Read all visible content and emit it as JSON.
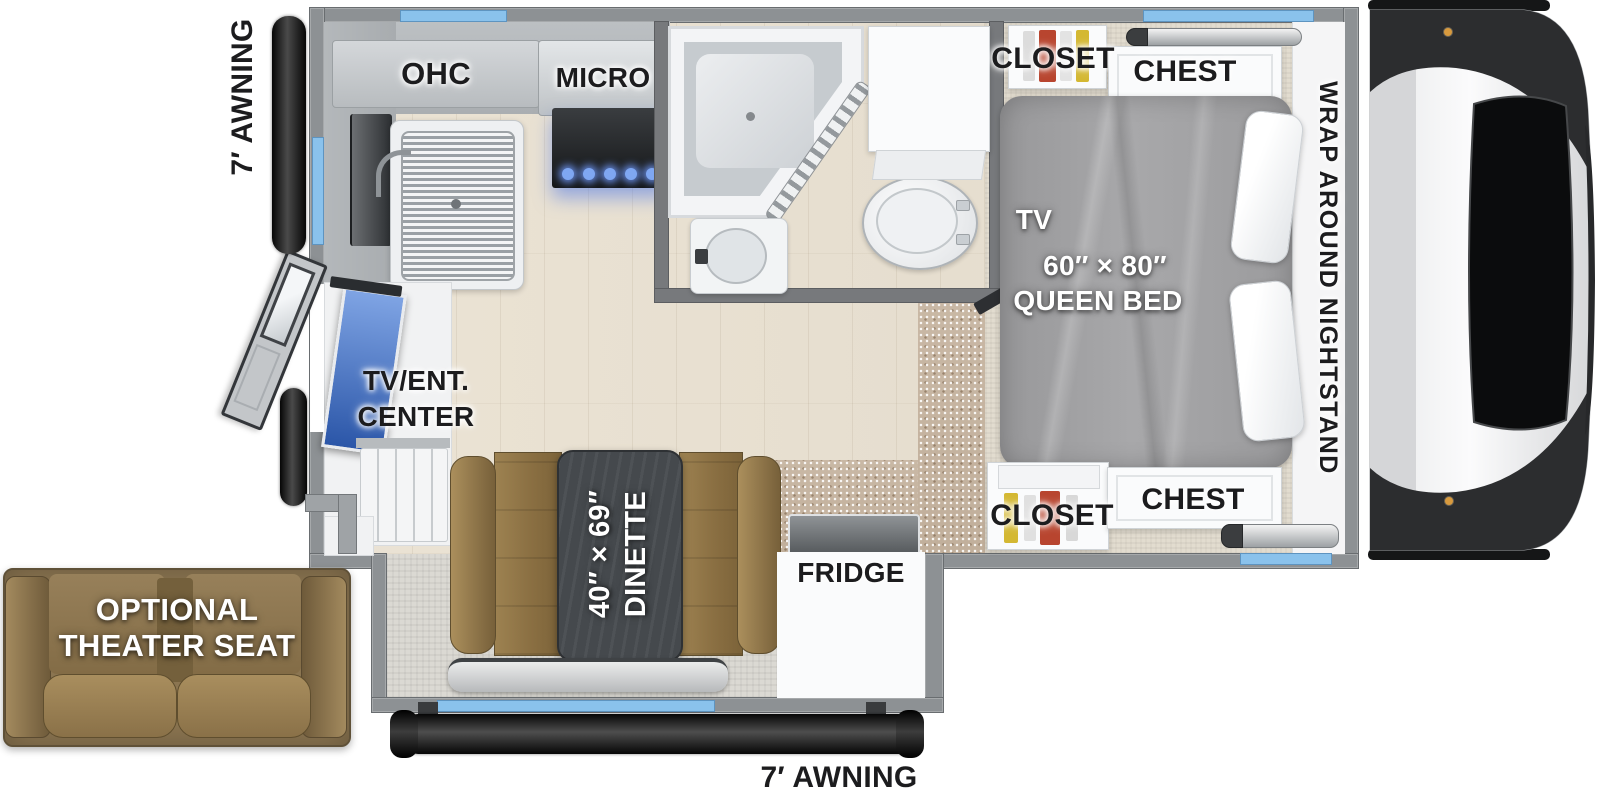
{
  "floorplan": {
    "title": "Truck camper floor plan",
    "labels": {
      "awning_left": "7′ AWNING",
      "awning_bottom": "7′ AWNING",
      "ohc": "OHC",
      "micro": "MICRO",
      "closet_top": "CLOSET",
      "chest_top": "CHEST",
      "wrap_nightstand": "WRAP AROUND NIGHTSTAND",
      "tv_bedroom": "TV",
      "bed_size": "60″ × 80″",
      "bed_name": "QUEEN BED",
      "tv_ent_line1": "TV/ENT.",
      "tv_ent_line2": "CENTER",
      "dinette_size": "40″ × 69″",
      "dinette_name": "DINETTE",
      "fridge": "FRIDGE",
      "closet_bottom": "CLOSET",
      "chest_bottom": "CHEST",
      "theater_line1": "OPTIONAL",
      "theater_line2": "THEATER SEAT"
    },
    "colors": {
      "window_blue": "#8ac2ec",
      "wall_gray": "#8d9194",
      "bathroom_wall_gray": "#77797c",
      "leather_brown": "#8a6f42",
      "table_dark": "#45494d",
      "burner_glow_blue": "#7fa7f2",
      "tv_screen_blue": "#2b56a8",
      "closet_red": "#b8452f",
      "closet_yellow": "#d4b832",
      "awning_black": "#0a0a0a",
      "bed_gray": "#a0a0a2",
      "carpet_tan": "#c9b8a5"
    }
  }
}
